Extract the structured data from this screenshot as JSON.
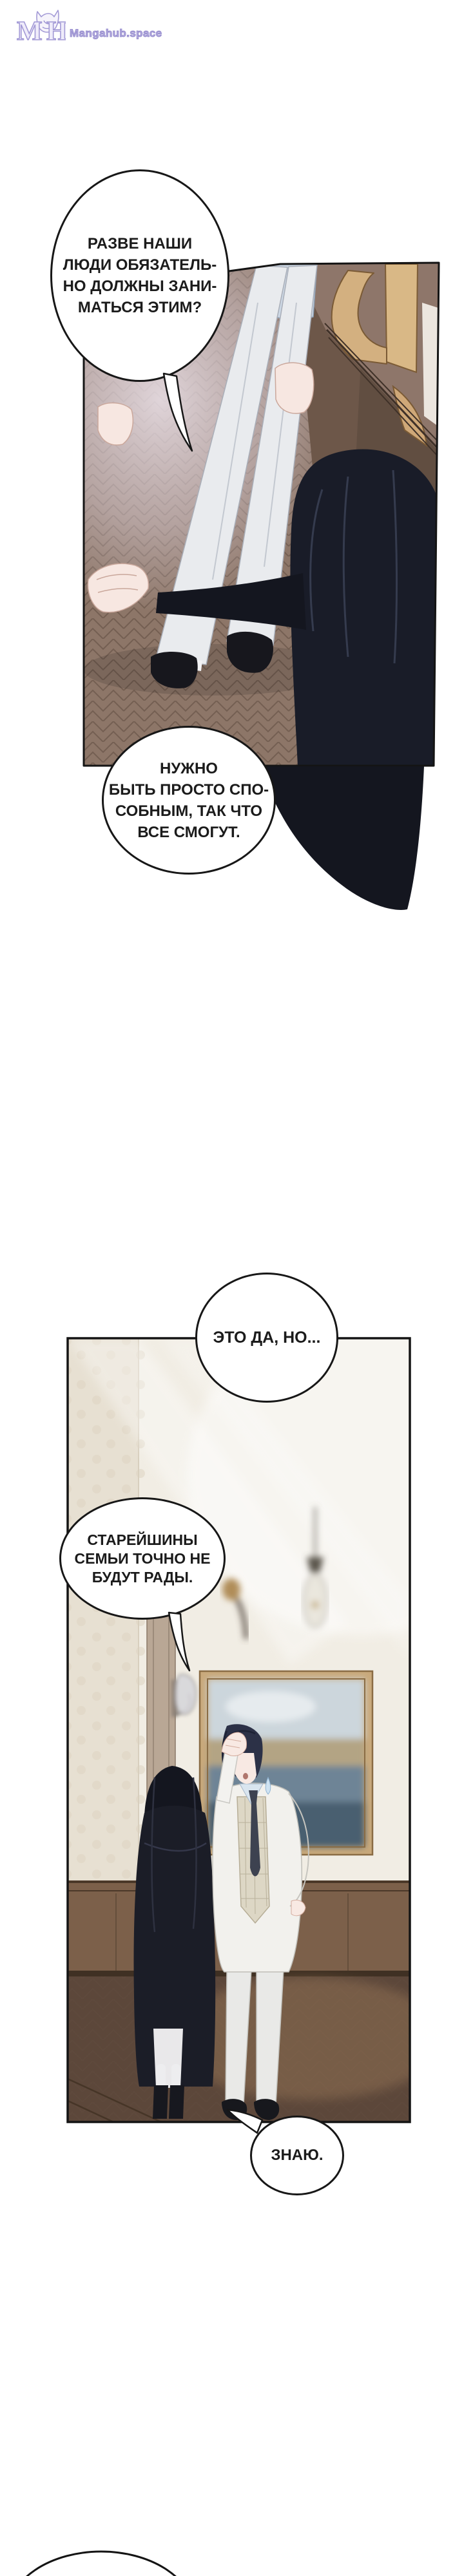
{
  "header": {
    "site_name": "Mangahub.space",
    "monogram": {
      "m": "M",
      "h": "H"
    },
    "brand_color": "#a39ad6"
  },
  "speech_bubbles": [
    {
      "id": "bubble-1",
      "lines": [
        "РАЗВЕ НАШИ",
        "ЛЮДИ ОБЯЗАТЕЛЬ-",
        "НО ДОЛЖНЫ ЗАНИ-",
        "МАТЬСЯ ЭТИМ?"
      ]
    },
    {
      "id": "bubble-2",
      "lines": [
        "НУЖНО",
        "БЫТЬ ПРОСТО СПО-",
        "СОБНЫМ, ТАК ЧТО",
        "ВСЕ СМОГУТ."
      ]
    },
    {
      "id": "bubble-3",
      "lines": [
        "ЭТО ДА, НО..."
      ]
    },
    {
      "id": "bubble-4",
      "lines": [
        "СТАРЕЙШИНЫ",
        "СЕМЬИ ТОЧНО НЕ",
        "БУДУТ РАДЫ."
      ]
    },
    {
      "id": "bubble-5",
      "lines": [
        "ЗНАЮ."
      ]
    },
    {
      "id": "bubble-6-partial",
      "lines": []
    }
  ],
  "palette": {
    "page_background": "#ffffff",
    "bubble_border": "#171717",
    "bubble_text": "#1b1b1b",
    "panel_border": "#141414",
    "floor_parquet_brown": "#8d7668",
    "wall_dark_brown": "#6d5749",
    "doorframe_gold": "#d3b080",
    "hair_black": "#14161f",
    "trousers_white": "#e9ebee",
    "room_wall_cream": "#f1ede4",
    "wainscot_wood": "#7c604a",
    "room_floor_brown": "#5c473a",
    "suit_white": "#f2f1ed",
    "vest_plaid": "#ddd7c5",
    "shirt_blue": "#d9e5ef",
    "skin": "#f8e9e3"
  }
}
